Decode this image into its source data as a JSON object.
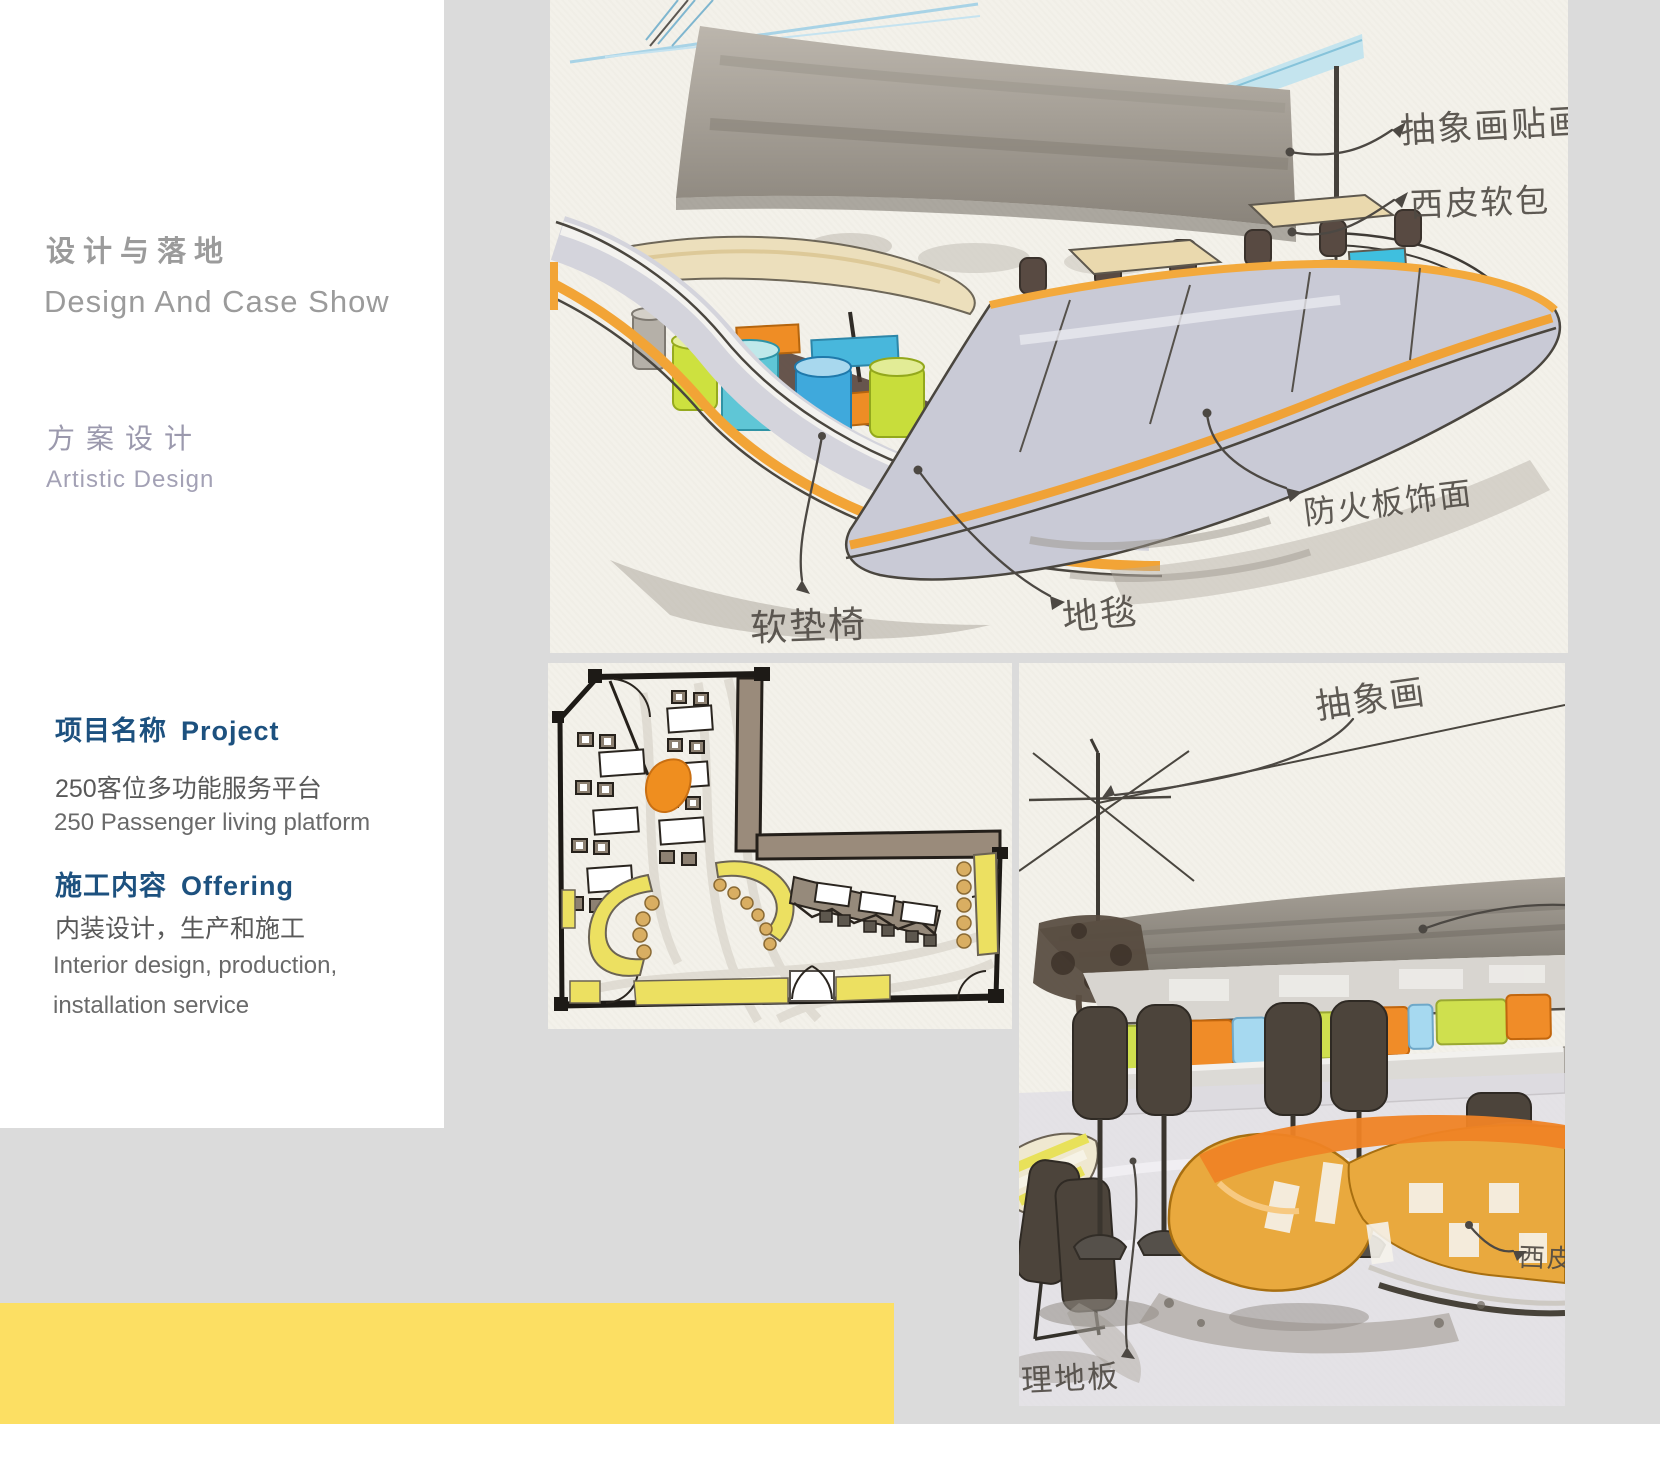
{
  "palette": {
    "page_gray": "#dbdbdb",
    "panel_white": "#ffffff",
    "accent_yellow": "#fcdf63",
    "heading_blue": "#1d517f",
    "muted_gray": "#9b9b9b",
    "lavender": "#9b99ad",
    "marker_orange": "#ef8d25",
    "marker_cyan": "#4cb6e0",
    "marker_lime": "#cde13f",
    "paper": "#f3f1ea"
  },
  "sidebar": {
    "section_title_zh": "设计与落地",
    "section_title_en": "Design And Case Show",
    "subsection_zh": "方案设计",
    "subsection_en": "Artistic Design",
    "project": {
      "heading_zh": "项目名称",
      "heading_en": "Project",
      "line_zh": "250客位多功能服务平台",
      "line_en": "250 Passenger living platform"
    },
    "offering": {
      "heading_zh": "施工内容",
      "heading_en": "Offering",
      "line_zh": "内装设计，生产和施工",
      "line_en1": "Interior design, production,",
      "line_en2": "installation service"
    }
  },
  "sketches": {
    "perspective_main": {
      "description": "hand-drawn marker perspective of restaurant booth seating",
      "annotations": [
        {
          "label": "抽象画贴画"
        },
        {
          "label": "西皮软包"
        },
        {
          "label": "防火板饰面"
        },
        {
          "label": "地毯"
        },
        {
          "label": "软垫椅"
        }
      ]
    },
    "floor_plan": {
      "description": "hand-drawn restaurant floor plan"
    },
    "perspective_secondary": {
      "description": "hand-drawn marker perspective with curved orange sofa",
      "annotations": [
        {
          "label": "抽象画"
        },
        {
          "label": "西皮"
        },
        {
          "label": "理地板"
        }
      ]
    }
  }
}
